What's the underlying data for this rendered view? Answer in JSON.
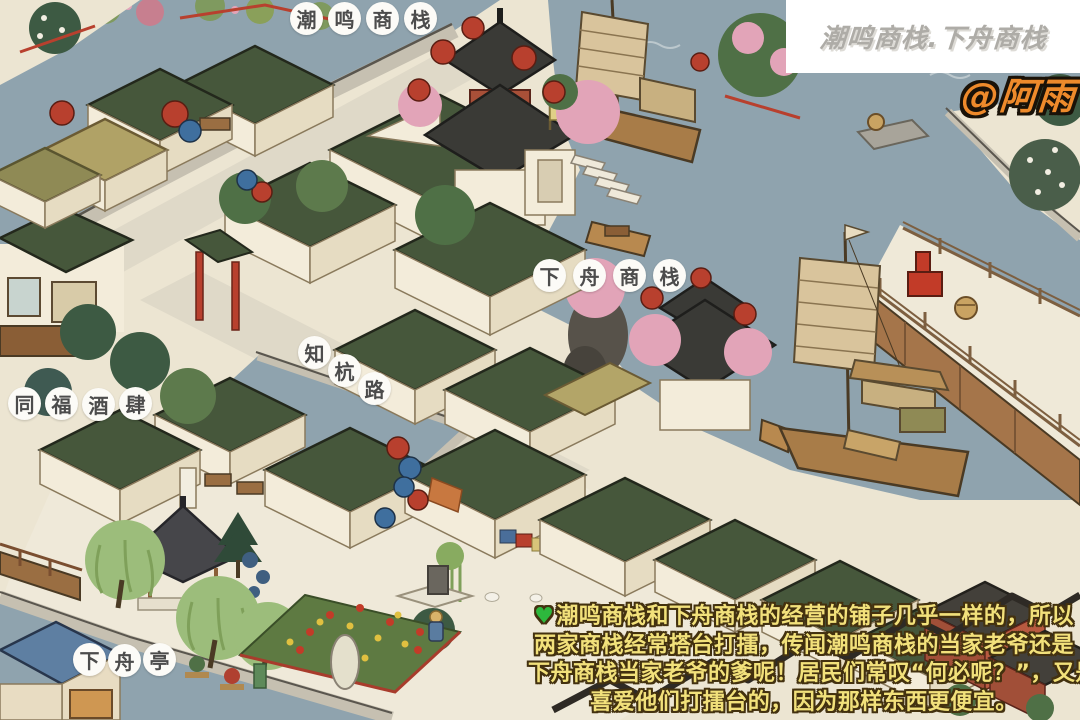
{
  "header": {
    "title": "潮鸣商栈.下舟商栈",
    "author": "@阿雨"
  },
  "map_labels": {
    "chaoming_inn": {
      "chars": [
        "潮",
        "鸣",
        "商",
        "栈"
      ]
    },
    "xiazhou_inn": {
      "chars": [
        "下",
        "舟",
        "商",
        "栈"
      ]
    },
    "zhihang_road": {
      "chars": [
        "知",
        "杭",
        "路"
      ]
    },
    "tongfu_tavern": {
      "chars": [
        "同",
        "福",
        "酒",
        "肆"
      ]
    },
    "xiazhou_pavilion": {
      "chars": [
        "下",
        "舟",
        "亭"
      ]
    }
  },
  "caption": {
    "icon": "♥",
    "lines": [
      "潮鸣商栈和下舟商栈的经营的铺子几乎一样的，所以",
      "两家商栈经常搭台打擂，传闻潮鸣商栈的当家老爷还是",
      "下舟商栈当家老爷的爹呢！居民们常叹“何必呢？”，又是",
      "喜爱他们打擂台的，因为那样东西更便宜。"
    ]
  },
  "scene": {
    "colors": {
      "ground": "#ece5d2",
      "plaza": "#efe9d9",
      "path": "#dfd9c8",
      "water": "#8fa3ae",
      "stone": "#c6c0b1",
      "stone_dark": "#5a564e",
      "roof_green": "#46573b",
      "roof_dark": "#3a3a36",
      "roof_blue": "#5e7fa2",
      "wall_cream": "#f3ecda",
      "wood": "#9a6e42",
      "wood_dark": "#4a3a24",
      "red": "#b8402e",
      "sail": "#d9c49c",
      "hull": "#a87c48",
      "willow": "#9cbd7b",
      "tree_mid": "#4f7046",
      "tree_dark": "#3d5a43",
      "blossom": "#e2a4b8",
      "label_text": "#4c4c4c",
      "title_gray": "#aeaca7",
      "author_orange": "#ee8a2b",
      "caption_yellow": "#f2e17b",
      "caption_outline": "#43310f"
    }
  }
}
